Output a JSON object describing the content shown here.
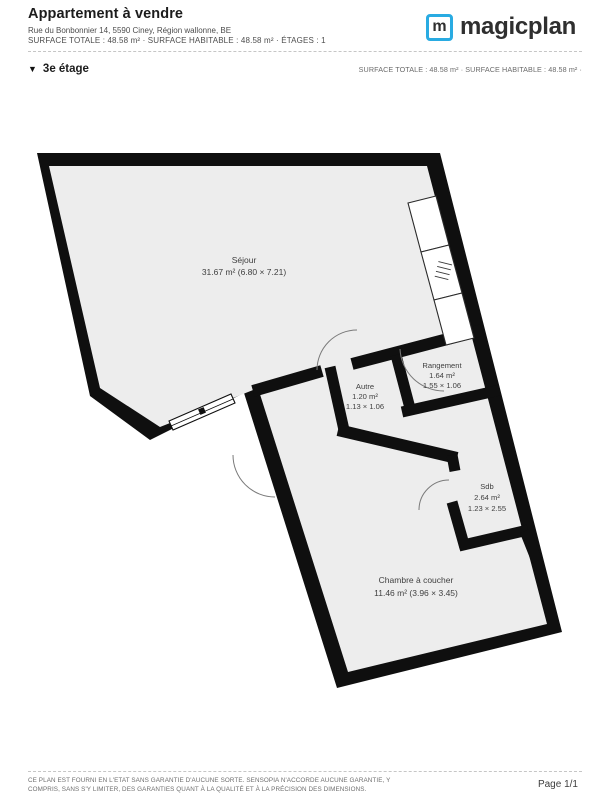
{
  "header": {
    "title": "Appartement à vendre",
    "address": "Rue du Bonbonnier 14, 5590 Ciney, Région wallonne, BE",
    "surface_line": "SURFACE TOTALE : 48.58 m² · SURFACE HABITABLE : 48.58 m² · ÉTAGES : 1",
    "brand": "magicplan",
    "brand_letter": "m",
    "brand_color": "#29abe2"
  },
  "floor_bar": {
    "collapse_icon": "▼",
    "floor_label": "3e étage",
    "surface_summary": "SURFACE TOTALE : 48.58 m² · SURFACE HABITABLE : 48.58 m² ·"
  },
  "plan": {
    "wall_color": "#0f0f0f",
    "room_fill": "#ededed",
    "rooms": {
      "sejour": {
        "name": "Séjour",
        "details": "31.67 m² (6.80 × 7.21)"
      },
      "autre": {
        "name": "Autre",
        "area": "1.20 m²",
        "dims": "1.13 × 1.06"
      },
      "rangement": {
        "name": "Rangement",
        "area": "1.64 m²",
        "dims": "1.55 × 1.06"
      },
      "sdb": {
        "name": "Sdb",
        "area": "2.64 m²",
        "dims": "1.23 × 2.55"
      },
      "chambre": {
        "name": "Chambre à coucher",
        "details": "11.46 m² (3.96 × 3.45)"
      }
    }
  },
  "footer": {
    "disclaimer_line1": "CE PLAN EST FOURNI EN L'ETAT SANS GARANTIE D'AUCUNE SORTE. SENSOPIA N'ACCORDE AUCUNE GARANTIE, Y",
    "disclaimer_line2": "COMPRIS, SANS S'Y LIMITER, DES GARANTIES QUANT À LA QUALITÉ ET À LA PRÉCISION DES DIMENSIONS.",
    "page": "Page 1/1"
  }
}
